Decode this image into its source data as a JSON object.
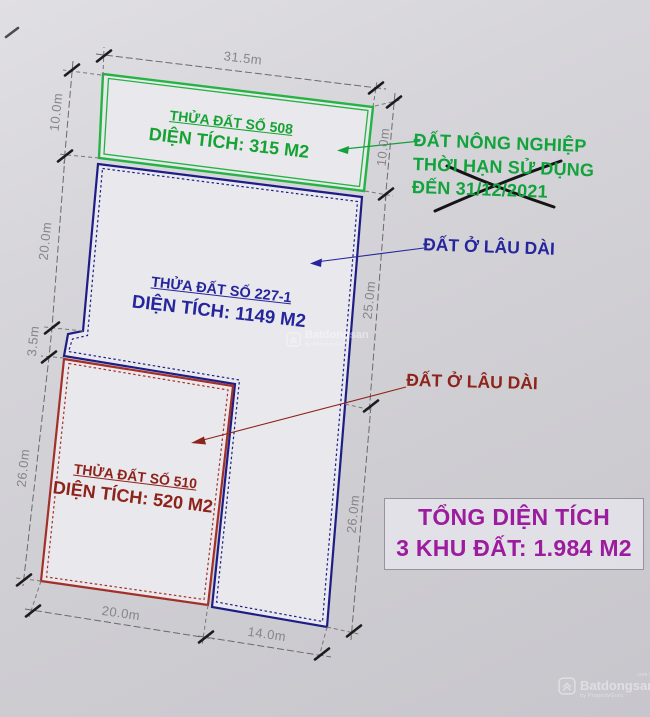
{
  "plots": [
    {
      "id": "508",
      "title": "THỬA ĐẤT SỐ 508",
      "area": "DIỆN TÍCH: 315 M2",
      "color": "#25b344"
    },
    {
      "id": "227-1",
      "title": "THỬA ĐẤT SỐ 227-1",
      "area": "DIỆN TÍCH: 1149 M2",
      "color": "#1d1d85"
    },
    {
      "id": "510",
      "title": "THỬA ĐẤT SỐ 510",
      "area": "DIỆN TÍCH: 520 M2",
      "color": "#a33028"
    }
  ],
  "annotations": {
    "agriculture": {
      "line1": "ĐẤT NÔNG NGHIỆP",
      "line2": "THỜI HẠN SỬ DỤNG",
      "line3": "ĐẾN 31/12/2021",
      "color": "#12a33c"
    },
    "residential_blue": {
      "text": "ĐẤT Ở LÂU DÀI",
      "color": "#26269c"
    },
    "residential_red": {
      "text": "ĐẤT Ở LÂU DÀI",
      "color": "#8e231b"
    }
  },
  "dimensions": {
    "top": "31.5m",
    "left_10": "10.0m",
    "left_20": "20.0m",
    "left_3_5": "3.5m",
    "left_26": "26.0m",
    "right_10": "10.0m",
    "right_25": "25.0m",
    "right_26": "26.0m",
    "bottom_20": "20.0m",
    "bottom_14": "14.0m"
  },
  "summary_box": {
    "line1": "TỔNG DIỆN TÍCH",
    "line2": "3 KHU ĐẤT: 1.984 M2",
    "color": "#9c1c9e"
  },
  "watermark": {
    "brand": "Batdongsan",
    "domain": "com.vn",
    "byline": "by PropertyGuru"
  }
}
